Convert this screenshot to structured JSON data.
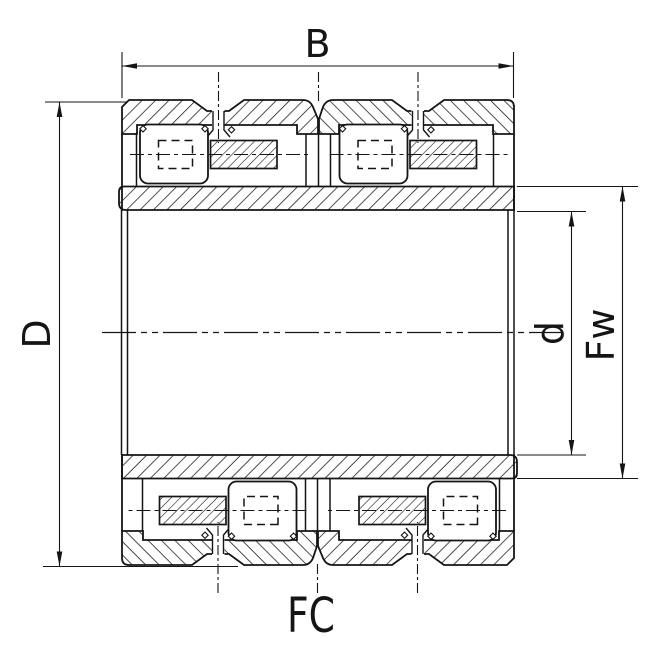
{
  "drawing": {
    "part_code": "FC",
    "dimension_labels": {
      "outer_width": "B",
      "outer_diameter": "D",
      "bore_diameter": "d",
      "raceway_diameter": "Fw"
    },
    "colors": {
      "line": "#151515",
      "background": "#ffffff"
    }
  }
}
